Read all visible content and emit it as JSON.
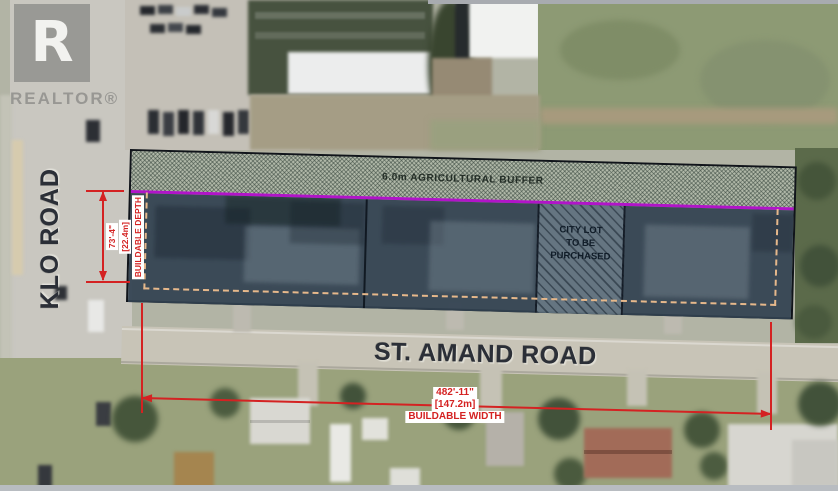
{
  "logo": {
    "mark": "R",
    "label": "REALTOR®"
  },
  "road_labels": {
    "klo": "KLO ROAD",
    "st_amand": "ST. AMAND ROAD"
  },
  "parcel": {
    "buffer_label": "6.0m AGRICULTURAL BUFFER",
    "city_lot_line1": "CITY LOT",
    "city_lot_line2": "TO BE",
    "city_lot_line3": "PURCHASED"
  },
  "dimensions": {
    "depth_imperial": "73'-4\"",
    "depth_metric": "[22.4m]",
    "depth_label": "BUILDABLE DEPTH",
    "width_imperial": "482'-11\"",
    "width_metric": "[147.2m]",
    "width_label": "BUILDABLE WIDTH"
  },
  "colors": {
    "dimension_red": "#d42222",
    "buffer_boundary_magenta": "#b114c9",
    "buildable_outline_tan": "#e6b88b",
    "overlay_slate": "#32424f",
    "buffer_hatch_green": "#aab9a6"
  }
}
